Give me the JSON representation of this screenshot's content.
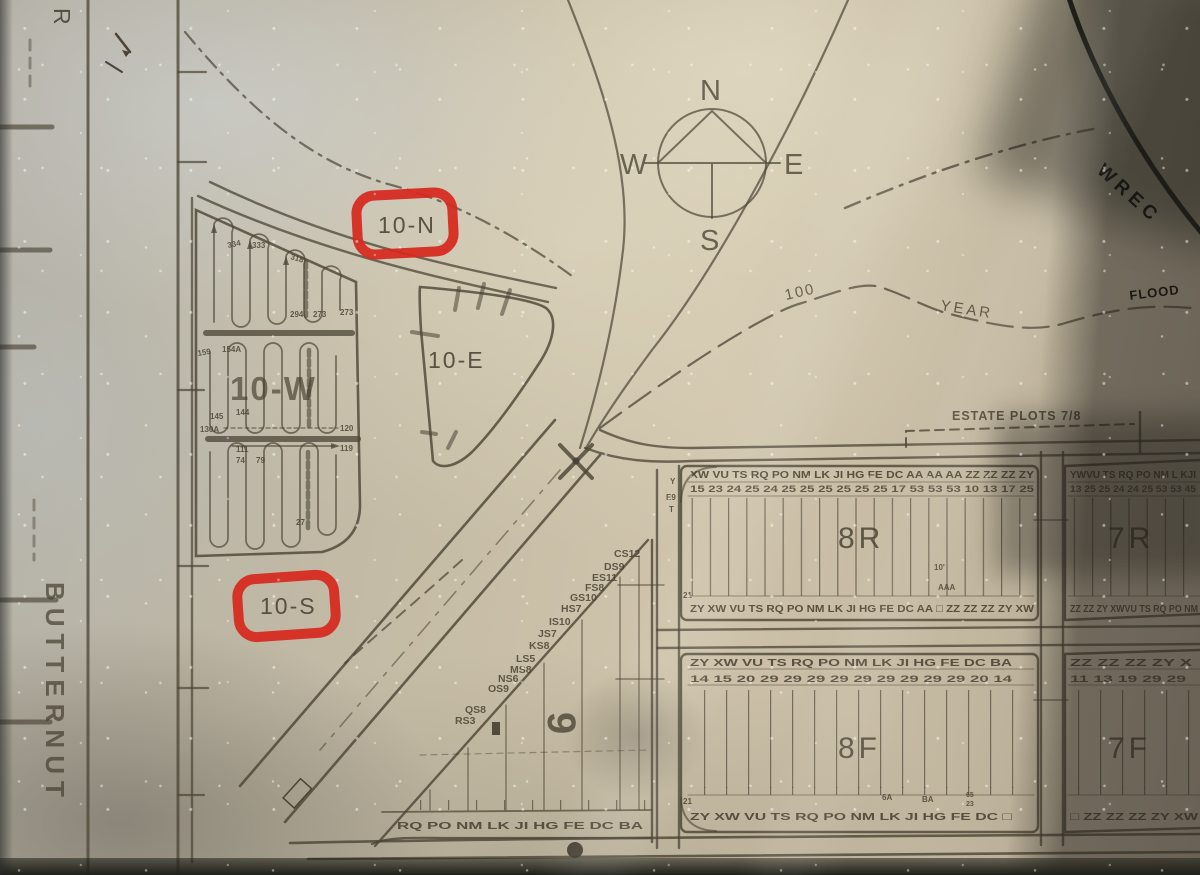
{
  "map": {
    "compass": {
      "north": "N",
      "south": "S",
      "east": "E",
      "west": "W"
    },
    "streets": {
      "left_vertical": "BUTTERNUT",
      "top_left_fragment": "R"
    },
    "annotations": {
      "flood_100": "100",
      "flood_year": "YEAR",
      "flood_label": "FLOOD",
      "wrec_fragment": "WREC",
      "estate_plots": "ESTATE PLOTS 7/8"
    },
    "highlight_color": "#d7271d",
    "sections": {
      "s10n": {
        "label": "10-N"
      },
      "s10e": {
        "label": "10-E"
      },
      "s10s": {
        "label": "10-S"
      },
      "s10w": {
        "label": "10-W",
        "numbers_top": [
          "334",
          "333",
          "318",
          "294",
          "273",
          "273"
        ],
        "numbers_mid": [
          "159",
          "154A",
          "145",
          "144",
          "130A",
          "120",
          "111",
          "119"
        ],
        "numbers_bottom": [
          "74",
          "79",
          "27"
        ]
      },
      "s9": {
        "label": "9",
        "edge_plots": [
          "CS12",
          "DS9",
          "ES11",
          "FS8",
          "GS10",
          "HS7",
          "IS10",
          "JS7",
          "KS8",
          "LS5",
          "MS8",
          "NS6",
          "OS9",
          "QS8",
          "RS3"
        ],
        "bottom_row": "RQ PO NM LK JI HG FE DC BA"
      },
      "s8r": {
        "label": "8R",
        "row_top_letters": "XW VU TS RQ PO NM LK JI HG FE DC AA AA AA ZZ ZZ ZZ ZY",
        "row_top_numbers": "15 23 24 25 24 25 25 25 25 25 25 17 53 53 53 10 13 17 25",
        "row_bottom_letters": "ZY XW VU TS RQ PO NM LK JI HG FE DC AA □ ZZ ZZ ZZ ZY XW",
        "left_marks": [
          "Y",
          "E9",
          "T"
        ],
        "mark_21": "21",
        "mark_10ft": "10'",
        "mark_aaa": "AAA"
      },
      "s7r": {
        "label": "7R",
        "row_top_letters": "YWVU TS RQ PO NM L KJI",
        "row_top_numbers": "13 25 25 24 24 25 53 53 45",
        "row_bottom_letters": "ZZ ZZ ZY XWVU TS RQ PO NM"
      },
      "s8f": {
        "label": "8F",
        "row_top_letters": "ZY XW VU TS RQ PO NM LK JI HG FE DC BA",
        "row_top_numbers": "14 15 20 29 29 29 29 29 29 29 29 29 20 14",
        "row_bottom_letters": "ZY XW VU TS RQ PO NM LK JI HG FE DC □",
        "mark_21": "21",
        "mark_6a": "6A",
        "mark_ba": "BA"
      },
      "s7f": {
        "label": "7F",
        "row_top_letters": "ZZ ZZ ZZ ZY X",
        "row_top_numbers": "11 13 19 29 29",
        "row_bottom_letters": "□ ZZ ZZ ZZ ZY XW",
        "left_marks": [
          "65",
          "23"
        ]
      }
    }
  }
}
